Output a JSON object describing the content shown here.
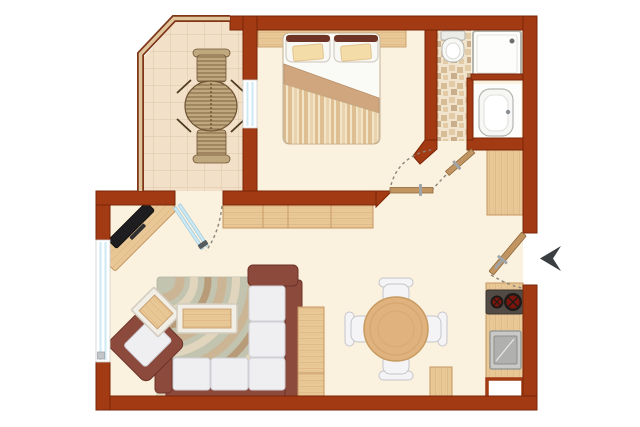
{
  "plan": {
    "kind": "apartment-floor-plan",
    "rooms": [
      "balcony",
      "bedroom",
      "bathroom",
      "living-room",
      "dining-area",
      "kitchenette",
      "entry-hall"
    ],
    "furniture": [
      "wicker-table",
      "wicker-chair",
      "double-bed",
      "headboard-shelf",
      "sideboard",
      "tv-stand",
      "tv",
      "corner-sofa",
      "armchair",
      "side-table",
      "coffee-table",
      "rug",
      "tall-cabinet",
      "dining-table",
      "dining-chair",
      "kitchen-counter",
      "cooktop",
      "kitchen-sink",
      "kitchen-cabinet",
      "wardrobe",
      "shower",
      "toilet",
      "washbasin",
      "entry-door",
      "bedroom-door",
      "bathroom-door",
      "balcony-glass-door",
      "windows",
      "entrance-arrow"
    ]
  },
  "colors": {
    "background": "#FFFFFF",
    "wall": "#A23A14",
    "wall_border": "#7A2606",
    "floor": "#FBF1DF",
    "balcony_tile": "#F3E0C8",
    "tile_line": "#DCC5A8",
    "rail_wood": "#E0C49C",
    "rail_edge": "#7F3517",
    "wood": "#E9C897",
    "wood_edge": "#C59660",
    "wood_grain": "#D8AF7C",
    "table_wood": "#DFB27E",
    "table_wood_edge": "#C79A60",
    "table_frame_white": "#F1EEE6",
    "table_frame_edge": "#D2CBBF",
    "sofa_frame": "#8C4A3D",
    "sofa_frame_edge": "#6B3328",
    "cushion": "#EFEFF2",
    "cushion_edge": "#CFCFD6",
    "chair_white": "#F4F4F6",
    "chair_edge": "#C5C5CA",
    "rug_base": "#C2C4B0",
    "rug_edge": "#B2B4A2",
    "rug_wave_tan": "#CDB28F",
    "rug_wave_cream": "#E9DAC0",
    "rug_wave_brown": "#B6946E",
    "glass": "#CDE9F4",
    "glass_edge": "#9CC9DC",
    "glass_handle": "#555B5E",
    "door_leaf": "#C09562",
    "door_leaf_edge": "#8F6A3C",
    "handle_metal": "#9FA4A8",
    "swing_dash": "#8A8578",
    "fixture_white": "#F7F7F5",
    "fixture_edge": "#B5B5B0",
    "alcove_white": "#FDFDFB",
    "cooktop": "#514A45",
    "burner_red": "#7E150C",
    "burner_dark": "#1F1A17",
    "sink_steel": "#C9C9C7",
    "sink_inner": "#B0B0AE",
    "arrow": "#3A3E41",
    "wicker": "#6E5433",
    "wicker_fill": "#C0A87E",
    "wicker_stick": "#4F3A20",
    "duvet_fold": "#CFA67D",
    "duvet_cream": "#F2E4C6",
    "duvet_tan": "#DFBE92",
    "duvet_mid": "#E9D2AC",
    "pillow_trim": "#6E3526",
    "pillow_tan": "#F4DCA8",
    "sheet_white": "#FAFAF7",
    "mosaic_a": "#E2CBA6",
    "mosaic_b": "#D8BC96",
    "mosaic_c": "#CAAE8C",
    "mosaic_d": "#F1E4CC",
    "tv_black": "#1E1E20"
  }
}
